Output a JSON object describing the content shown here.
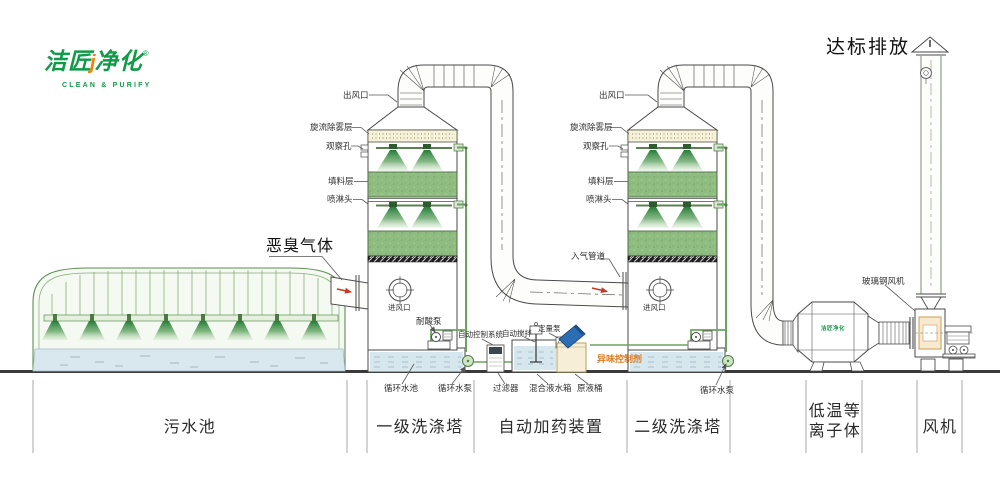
{
  "logo": {
    "brand_left": "洁匠",
    "accent": "j",
    "brand_right": "净化",
    "reg": "®",
    "tagline": "CLEAN & PURIFY"
  },
  "discharge": "达标排放",
  "odor_gas": "恶臭气体",
  "tower_labels": {
    "outlet": "出风口",
    "demister": "旋流除雾层",
    "sight_hole": "观察孔",
    "packing": "填料层",
    "spray_head": "喷淋头",
    "air_inlet": "进风口"
  },
  "misc": {
    "inlet_duct": "入气管道"
  },
  "pumps": {
    "acid_pump": "耐酸泵",
    "circ_pool": "循环水池",
    "circ_pump": "循环水泵"
  },
  "dosing": {
    "control_system": "自动控制系统",
    "auto_stir": "自动搅拌",
    "metering_pump": "定量泵",
    "odor_agent": "异味控制剂",
    "filter": "过滤器",
    "mix_tank": "混合液水箱",
    "raw_barrel": "原液桶"
  },
  "fan_area": {
    "frp_fan": "玻璃钢风机"
  },
  "plasma": {
    "badge": "洁匠净化"
  },
  "sections": {
    "pool": "污水池",
    "tower1": "一级洗涤塔",
    "dosing": "自动加药装置",
    "tower2": "二级洗涤塔",
    "plasma_l1": "低温等",
    "plasma_l2": "离子体",
    "fan": "风机"
  },
  "colors": {
    "brand_green": "#0f9b47",
    "accent_orange": "#f08300",
    "packing_green": "#8fbc80",
    "water_blue": "#d9e8ee",
    "cream": "#f6f2da",
    "agent_orange": "#e07a1f",
    "arrow_red": "#c63826"
  }
}
